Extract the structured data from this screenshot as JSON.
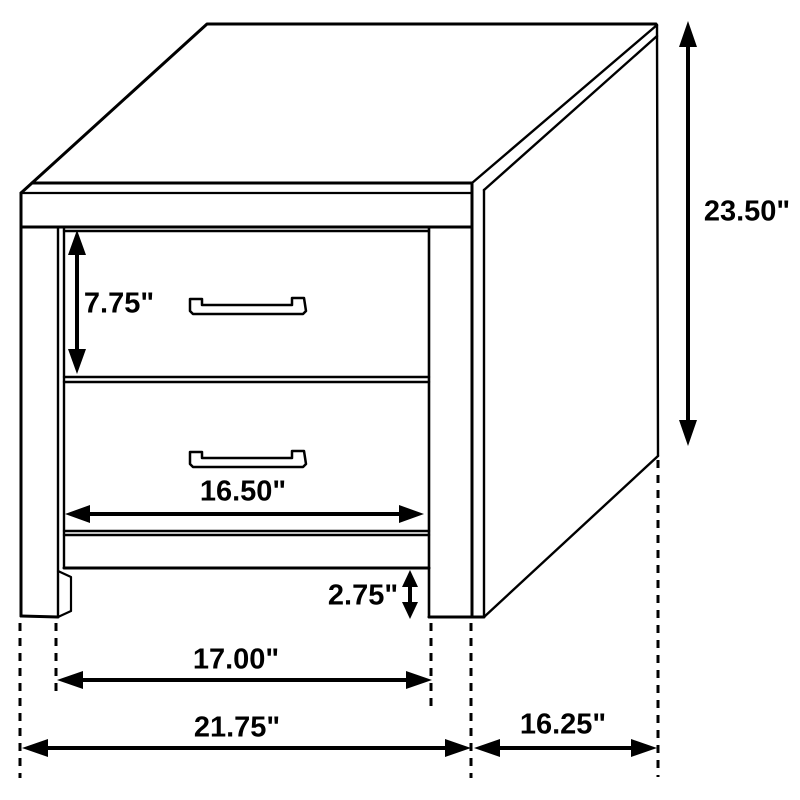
{
  "diagram": {
    "subject": "2-drawer nightstand dimension drawing",
    "colors": {
      "line": "#000000",
      "background": "#ffffff",
      "text": "#000000"
    },
    "measurements": {
      "overall_height": "23.50\"",
      "drawer_height": "7.75\"",
      "drawer_opening_width": "16.50\"",
      "floor_clearance": "2.75\"",
      "leg_spacing": "17.00\"",
      "overall_width": "21.75\"",
      "overall_depth": "16.25\""
    }
  }
}
